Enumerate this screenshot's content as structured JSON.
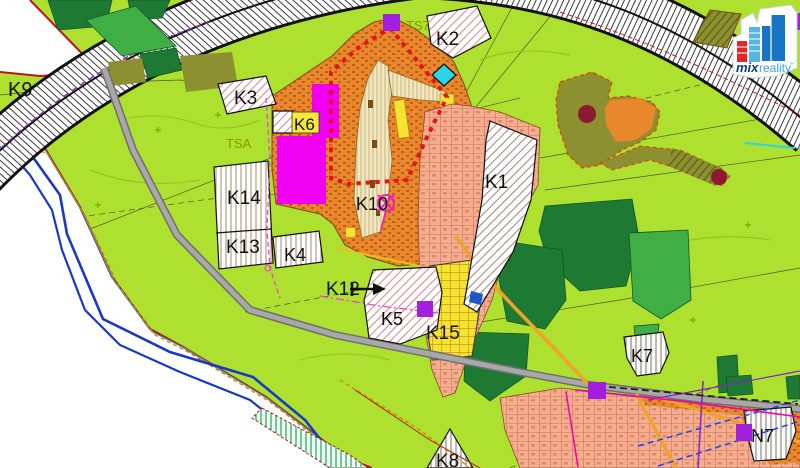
{
  "map": {
    "title": "zoning-plan-map",
    "zone_labels": [
      {
        "id": "K9",
        "text": "K9",
        "x": 8,
        "y": 96,
        "size": 20,
        "color": "#111111"
      },
      {
        "id": "TS7",
        "text": "TS7",
        "x": 406,
        "y": 30,
        "size": 13,
        "color": "#8F9800"
      },
      {
        "id": "K2",
        "text": "K2",
        "x": 436,
        "y": 45,
        "size": 19,
        "color": "#111111"
      },
      {
        "id": "K3",
        "text": "K3",
        "x": 234,
        "y": 104,
        "size": 19,
        "color": "#111111"
      },
      {
        "id": "K6",
        "text": "K6",
        "x": 294,
        "y": 130,
        "size": 17,
        "color": "#111111"
      },
      {
        "id": "TSA",
        "text": "TSA",
        "x": 226,
        "y": 148,
        "size": 13,
        "color": "#8F9800"
      },
      {
        "id": "K1",
        "text": "K1",
        "x": 485,
        "y": 188,
        "size": 19,
        "color": "#111111"
      },
      {
        "id": "K14",
        "text": "K14",
        "x": 227,
        "y": 204,
        "size": 19,
        "color": "#111111"
      },
      {
        "id": "K10",
        "text": "K10",
        "x": 356,
        "y": 210,
        "size": 18,
        "color": "#111111"
      },
      {
        "id": "K13",
        "text": "K13",
        "x": 226,
        "y": 253,
        "size": 19,
        "color": "#111111"
      },
      {
        "id": "K4",
        "text": "K4",
        "x": 284,
        "y": 261,
        "size": 18,
        "color": "#111111"
      },
      {
        "id": "K12",
        "text": "K12",
        "x": 326,
        "y": 295,
        "size": 19,
        "color": "#111111"
      },
      {
        "id": "K5",
        "text": "K5",
        "x": 381,
        "y": 325,
        "size": 18,
        "color": "#111111"
      },
      {
        "id": "K15",
        "text": "K15",
        "x": 426,
        "y": 339,
        "size": 19,
        "color": "#111111"
      },
      {
        "id": "K7",
        "text": "K7",
        "x": 631,
        "y": 362,
        "size": 18,
        "color": "#111111"
      },
      {
        "id": "K8",
        "text": "K8",
        "x": 436,
        "y": 467,
        "size": 19,
        "color": "#111111"
      },
      {
        "id": "N7",
        "text": "N7",
        "x": 751,
        "y": 442,
        "size": 18,
        "color": "#111111"
      }
    ],
    "markers": {
      "purple_squares": [
        {
          "x": 383,
          "y": 14,
          "w": 17,
          "h": 17
        },
        {
          "x": 417,
          "y": 301,
          "w": 16,
          "h": 16
        },
        {
          "x": 588,
          "y": 382,
          "w": 18,
          "h": 17
        },
        {
          "x": 736,
          "y": 424,
          "w": 16,
          "h": 17
        },
        {
          "x": 787,
          "y": 13,
          "w": 13,
          "h": 17
        }
      ],
      "maroon_circles": [
        {
          "cx": 587,
          "cy": 114,
          "r": 9
        },
        {
          "cx": 719,
          "cy": 177,
          "r": 8
        }
      ]
    },
    "palette": {
      "field_green": "#ADE02F",
      "forest_dark": "#1E7A33",
      "forest_medium": "#3FAE45",
      "olive": "#8D9030",
      "village_orange": "#E8872B",
      "salmon": "#F3AE92",
      "cream": "#F1E7C0",
      "yellow": "#F2E430",
      "magenta_area": "#F000F0",
      "purple_marker": "#A21FDD",
      "cyan_marker": "#2ED3E8",
      "maroon_marker": "#8C1A30",
      "change_boundary_red": "#E81010",
      "river_blue": "#1838C8",
      "road_gray": "#9B9B9B"
    }
  },
  "logo": {
    "mix": "mix",
    "reality": "reality",
    "trademark": "™"
  }
}
